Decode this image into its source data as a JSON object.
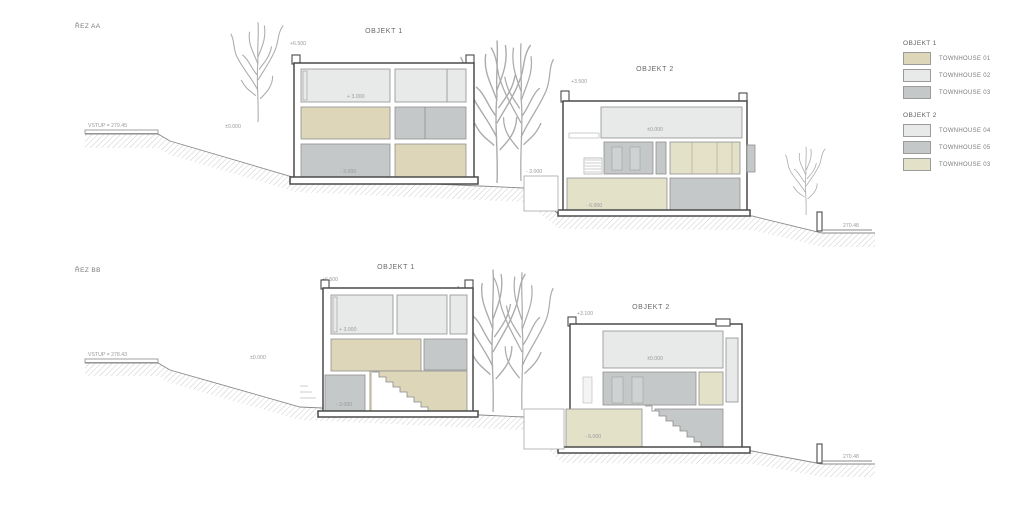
{
  "colors": {
    "th01": "#ddd6b8",
    "th02": "#e8eaea",
    "th03_gray": "#c5c8c8",
    "th03_beige": "#e4e1c9"
  },
  "legend": {
    "groups": [
      {
        "title": "OBJEKT 1",
        "items": [
          {
            "label": "TOWNHOUSE 01",
            "color": "#ddd6b8"
          },
          {
            "label": "TOWNHOUSE 02",
            "color": "#e8eaea"
          },
          {
            "label": "TOWNHOUSE 03",
            "color": "#c5c8c8"
          }
        ]
      },
      {
        "title": "OBJEKT 2",
        "items": [
          {
            "label": "TOWNHOUSE 04",
            "color": "#e8eaea"
          },
          {
            "label": "TOWNHOUSE 05",
            "color": "#c5c8c8"
          },
          {
            "label": "TOWNHOUSE 03",
            "color": "#e4e1c9"
          }
        ]
      }
    ]
  },
  "sections": {
    "aa": {
      "name": "ŘEZ AA",
      "vstup": "VSTUP = 279.45",
      "entry_level": "±0.000",
      "terrain_right": "270.48",
      "objekt1": {
        "title": "OBJEKT 1",
        "roof": "+6.500",
        "level_upper": "+ 3.000",
        "level_lower": "- 3.000"
      },
      "objekt2": {
        "title": "OBJEKT 2",
        "roof": "+3.500",
        "level_ground": "±0.000",
        "level_basement": "- 6.000",
        "level_side": "- 3.000"
      }
    },
    "bb": {
      "name": "ŘEZ BB",
      "vstup": "VSTUP = 278.43",
      "entry_level": "±0.000",
      "terrain_right": "270.48",
      "objekt1": {
        "title": "OBJEKT 1",
        "roof": "+6.500",
        "level_upper": "+ 3.000",
        "level_lower": "- 3.000"
      },
      "objekt2": {
        "title": "OBJEKT 2",
        "roof": "+3.100",
        "level_ground": "±0.000",
        "level_basement": "- 6.000"
      }
    }
  }
}
